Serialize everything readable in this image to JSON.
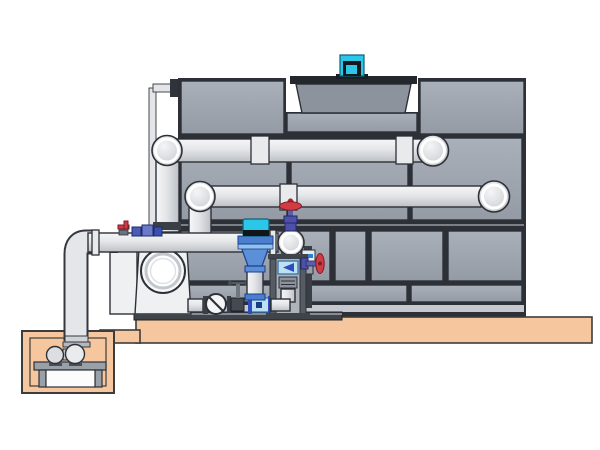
{
  "title": "Cooling tower and condenser water pump system — 3D piping illustration",
  "colors": {
    "background": "#ffffff",
    "tower_panel": "#9da3ad",
    "panel_gap": "#2d3137",
    "outline": "#2d3137",
    "pipe_light": "#eceef0",
    "pipe_shadow": "#c2c6cb",
    "slab": "#f6c79e",
    "motor_cyan": "#2cc7e8",
    "valve_red": "#d23a44",
    "valve_blue": "#4a5cb4",
    "pump_blue": "#5b8fd8",
    "pump_white": "#eef0f2",
    "filter_blue": "#bfe0f2"
  },
  "components": [
    {
      "name": "cooling-tower",
      "description": "panelized cooling tower casing"
    },
    {
      "name": "fan-cowl",
      "description": "fan cylinder on tower roof"
    },
    {
      "name": "fan-motor",
      "description": "cyan fan drive motor"
    },
    {
      "name": "upper-supply-pipe",
      "description": "upper horizontal pipe entering tower"
    },
    {
      "name": "middle-return-pipe",
      "description": "lower horizontal pipe entering tower"
    },
    {
      "name": "makeup-water-pipe",
      "description": "thin vertical line to tower"
    },
    {
      "name": "suction-header-pipe",
      "description": "horizontal header on pump skid"
    },
    {
      "name": "riser-pipe",
      "description": "vertical pipe down to sump pit"
    },
    {
      "name": "centrifugal-pump",
      "description": "large end-suction pump with round inlet"
    },
    {
      "name": "vertical-inline-pump",
      "description": "inline pump with cyan motor and blue diffuser"
    },
    {
      "name": "globe-valve-red-handwheel",
      "description": "red handwheel valve on header elbow"
    },
    {
      "name": "side-red-handwheel-valve",
      "description": "red handwheel valve on filter stand"
    },
    {
      "name": "check-valve",
      "description": "wafer check valve, circle with slash"
    },
    {
      "name": "gate-valve",
      "description": "small gate valve with T handle"
    },
    {
      "name": "blue-isolation-valves",
      "description": "small blue valve cluster on header"
    },
    {
      "name": "filter-stand",
      "description": "frame with strainer cartridge and elbow"
    },
    {
      "name": "skid-base",
      "description": "dark steel base rail"
    },
    {
      "name": "concrete-slab",
      "description": "tan equipment pad"
    },
    {
      "name": "sump-pit",
      "description": "tan below-grade pit"
    },
    {
      "name": "sump-pump",
      "description": "horizontal pump set on stand in pit"
    }
  ]
}
